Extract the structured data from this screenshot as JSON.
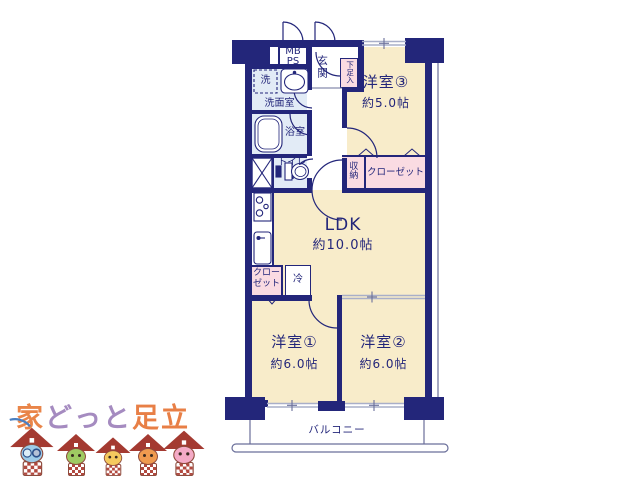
{
  "floorplan": {
    "colors": {
      "wall": "#23267a",
      "room_fill": "#f8ecca",
      "wet_area_fill": "#e2ebf6",
      "closet_fill": "#fadbe2",
      "window_line": "#a9afc9"
    },
    "rooms": {
      "room3": {
        "name": "洋室③",
        "size": "約5.0帖"
      },
      "ldk": {
        "name": "LDK",
        "size": "約10.0帖"
      },
      "room1": {
        "name": "洋室①",
        "size": "約6.0帖"
      },
      "room2": {
        "name": "洋室②",
        "size": "約6.0帖"
      }
    },
    "labels": {
      "mb": "MB",
      "ps": "PS",
      "entrance": "玄関",
      "shoe_box": "下足入",
      "washer": "洗",
      "washroom": "洗面室",
      "bath": "浴室",
      "toilet": "トイレ",
      "storage": "収納",
      "closet_upper": "クローゼット",
      "closet_lower": "クローゼット",
      "fridge": "冷",
      "balcony": "バルコニー"
    }
  },
  "logo": {
    "segments": [
      {
        "text": "家",
        "color": "#e98549"
      },
      {
        "text": "どっと",
        "color": "#a58bc0"
      },
      {
        "text": "足立",
        "color": "#e87f46"
      }
    ],
    "mascots": [
      {
        "name": "blue-house-mascot",
        "face": "#9ecbe8"
      },
      {
        "name": "green-house-mascot",
        "face": "#9fca62"
      },
      {
        "name": "yellow-house-mascot",
        "face": "#f5c95e"
      },
      {
        "name": "orange-house-mascot",
        "face": "#ef9a4f"
      },
      {
        "name": "pink-house-mascot",
        "face": "#f4aac6"
      }
    ]
  }
}
